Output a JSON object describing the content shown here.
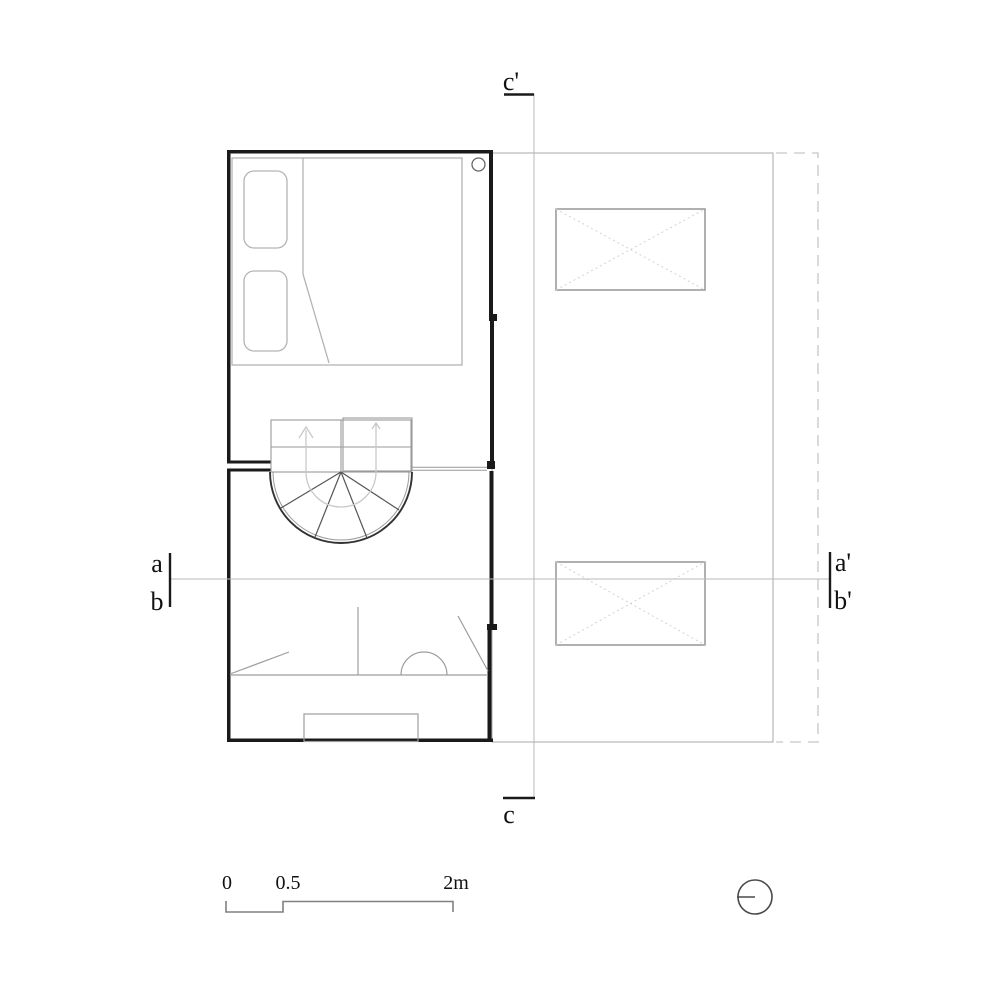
{
  "plan": {
    "title": "architectural floor plan",
    "labels": {
      "c_prime": "c'",
      "c": "c",
      "a": "a",
      "b": "b",
      "a_prime": "a'",
      "b_prime": "b'"
    },
    "scale": {
      "zero": "0",
      "half": "0.5",
      "max": "2m"
    },
    "colors": {
      "wall": "#1a1a1a",
      "furniture_line": "#b3b3b3",
      "fixture_line": "#9e9e9e",
      "stair_arc": "#333333",
      "area_line": "#a8a8a8",
      "skylight_diagonal": "#d2d2d2",
      "dashed_line": "#c6c6c6",
      "section_line": "#b8b8b8",
      "label": "#111111",
      "background": "#ffffff"
    }
  }
}
